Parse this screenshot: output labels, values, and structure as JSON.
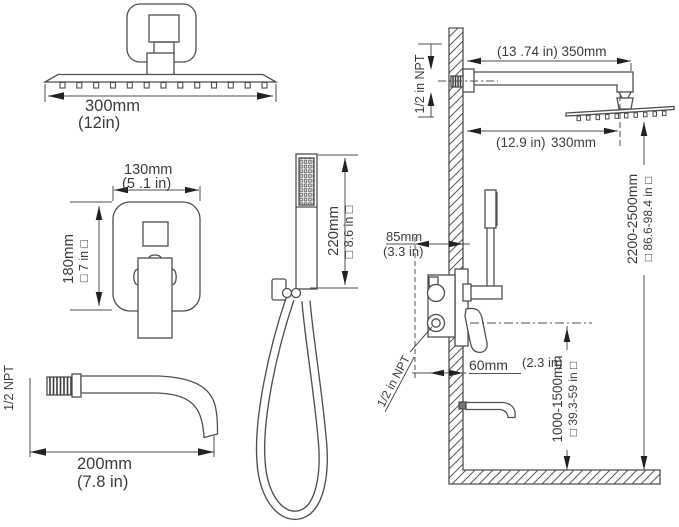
{
  "colors": {
    "background": "#ffffff",
    "line": "#4f4f4f",
    "text": "#3c3c3c",
    "arrow": "#222222"
  },
  "views": {
    "shower_head_front": {
      "width_mm": "300mm",
      "width_in": "(12in)"
    },
    "valve_front": {
      "width_mm": "130mm",
      "width_in": "(5 .1 in)",
      "height_mm": "180mm",
      "height_in": "□ 7 in □"
    },
    "hand_shower_front": {
      "height_mm": "220mm",
      "height_in": "□ 8.6 in □"
    },
    "tub_spout_side": {
      "thread": "1/2 NPT",
      "length_mm": "200mm",
      "length_in": "(7.8 in)"
    },
    "installation_side": {
      "arm_thread": "1/2 in NPT",
      "arm_length": "(13 .74 in) 350mm",
      "head_offset_in": "(12.9 in)",
      "head_offset_mm": "330mm",
      "head_height_mm": "2200-2500mm",
      "head_height_in": "□ 86.6-98.4 in □",
      "valve_depth_mm": "85mm",
      "valve_depth_in": "(3.3 in)",
      "spout_offset_mm": "60mm",
      "spout_offset_in": "(2.3 in)",
      "valve_thread": "1/2 in NPT",
      "spout_height_mm": "1000-1500mm",
      "spout_height_in": "□ 39.3-59 in □"
    }
  }
}
